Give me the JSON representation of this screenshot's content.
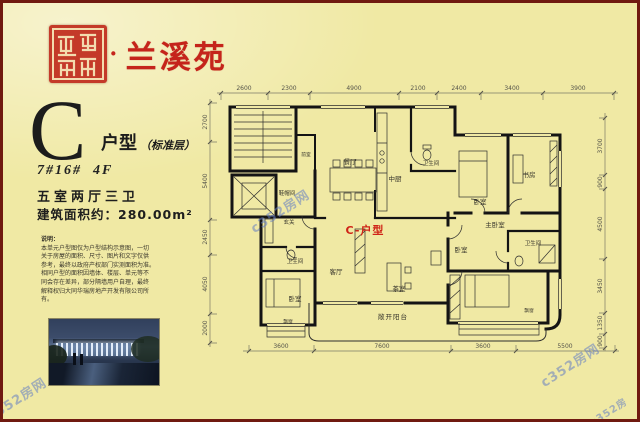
{
  "colors": {
    "background": "#f0e9a4",
    "frame": "#701a10",
    "brand_red": "#c5241b",
    "plan_title_red": "#cf2417",
    "watermark_blue": "#647dc3"
  },
  "header": {
    "separator": "·",
    "brand": "兰溪苑"
  },
  "unit": {
    "letter": "C",
    "type_label": "户型",
    "floor_note": "（标准层）",
    "building_no": "7#16#  4F",
    "rooms_summary": "五室两厅三卫",
    "area_line": "建筑面积约：280.00m²"
  },
  "disclaimer": {
    "title": "说明：",
    "lines": [
      "本单元户型图仅为户型结构示意图，一切",
      "关于房屋的面积、尺寸、图片和文字仅供",
      "参考，最终以政府产权部门实测面积为准。",
      "相同户型的面积因墙体、楼层、单元等不",
      "同会存在差异，部分隔墙用户自理，最终",
      "解释权归大同华瑞房地产开发有限公司所",
      "有。"
    ]
  },
  "plan": {
    "title": "C-户型",
    "balcony_label": "敞开阳台",
    "rooms": [
      {
        "label": "餐厅"
      },
      {
        "label": "中厨"
      },
      {
        "label": "卫生间"
      },
      {
        "label": "卧室"
      },
      {
        "label": "书房"
      },
      {
        "label": "主卧室"
      },
      {
        "label": "卫生间"
      },
      {
        "label": "鞋帽间"
      },
      {
        "label": "玄关"
      },
      {
        "label": "卫生间"
      },
      {
        "label": "卧室"
      },
      {
        "label": "飘窗"
      },
      {
        "label": "客厅"
      },
      {
        "label": "茶室"
      },
      {
        "label": "卧室"
      },
      {
        "label": "飘窗"
      },
      {
        "label": "前室"
      }
    ],
    "dims": {
      "top": [
        "2600",
        "2300",
        "4900",
        "2100",
        "2400",
        "3400",
        "3900"
      ],
      "bottom": [
        "3600",
        "7600",
        "3600",
        "5500"
      ],
      "left": [
        "2700",
        "5400",
        "2450",
        "4050",
        "2000"
      ],
      "right": [
        "3700",
        "900",
        "4500",
        "3450",
        "1350",
        "900"
      ]
    }
  },
  "watermark": {
    "text": "c352房网"
  }
}
